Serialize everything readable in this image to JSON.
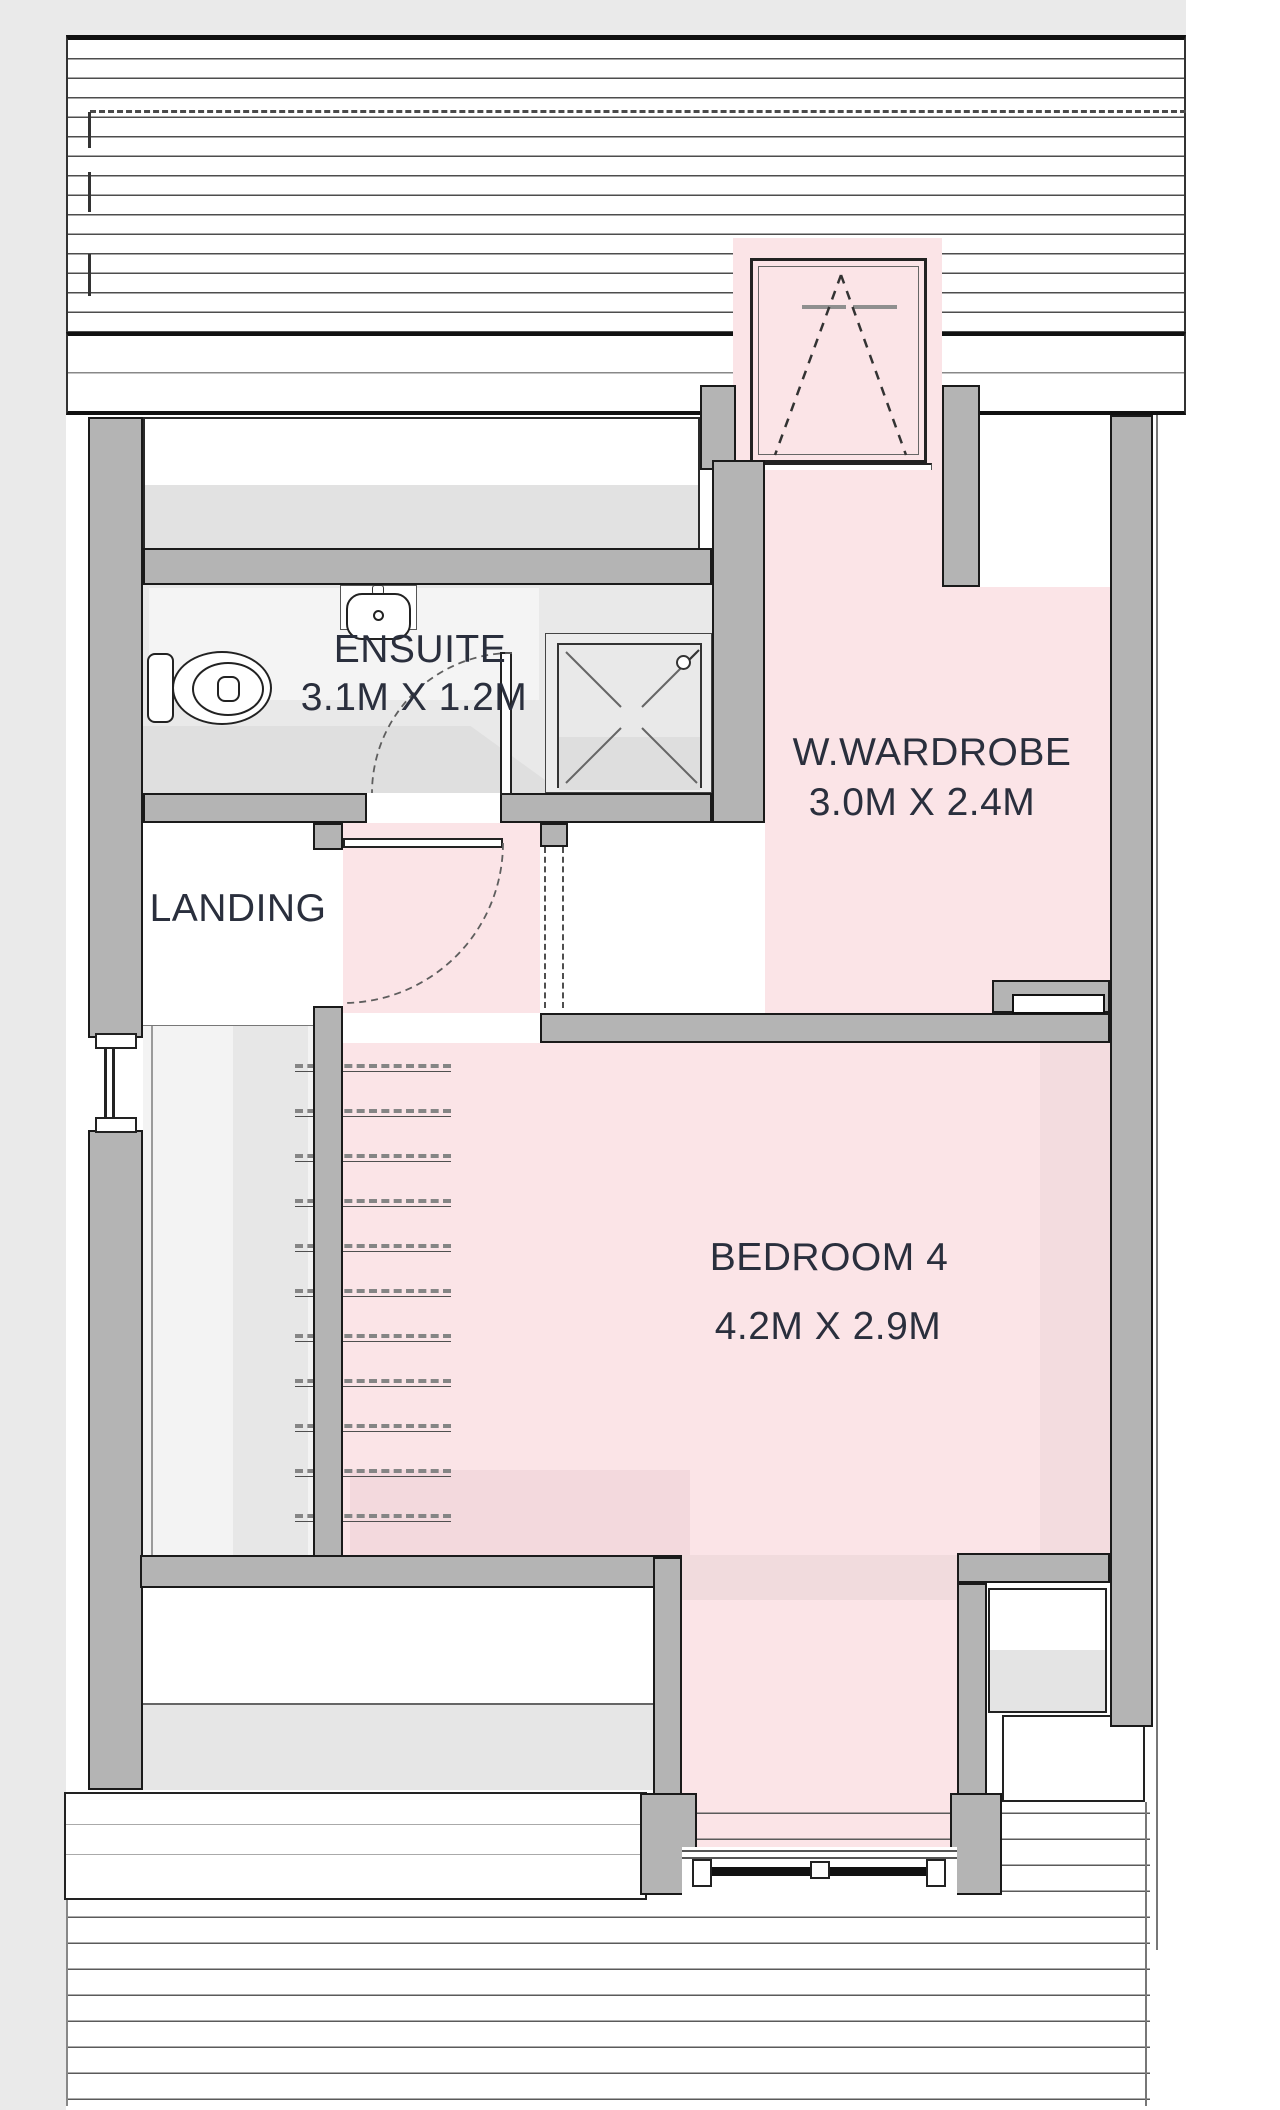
{
  "title": "Floor plan - loft level",
  "colors": {
    "room_pink": "#fbe4e7",
    "wall_gray": "#b4b4b4",
    "outline_black": "#1a1a1a",
    "label_text": "#2a2f3d",
    "page_margin_gray": "#eaeaea",
    "ensuite_floor_gray": "#e9e9e9"
  },
  "rooms": {
    "ensuite": {
      "name": "ENSUITE",
      "dimensions": "3.1M X 1.2M"
    },
    "landing": {
      "name": "LANDING",
      "dimensions": ""
    },
    "wardrobe": {
      "name": "W.WARDROBE",
      "dimensions": "3.0M X 2.4M"
    },
    "bedroom4": {
      "name": "BEDROOM 4",
      "dimensions": "4.2M X 2.9M"
    }
  },
  "fixtures": [
    "toilet-icon",
    "sink-icon",
    "shower-icon",
    "stairs-icon",
    "skylight-window-icon",
    "dormer-window-icon",
    "side-window-icon",
    "door-swing-icon"
  ]
}
